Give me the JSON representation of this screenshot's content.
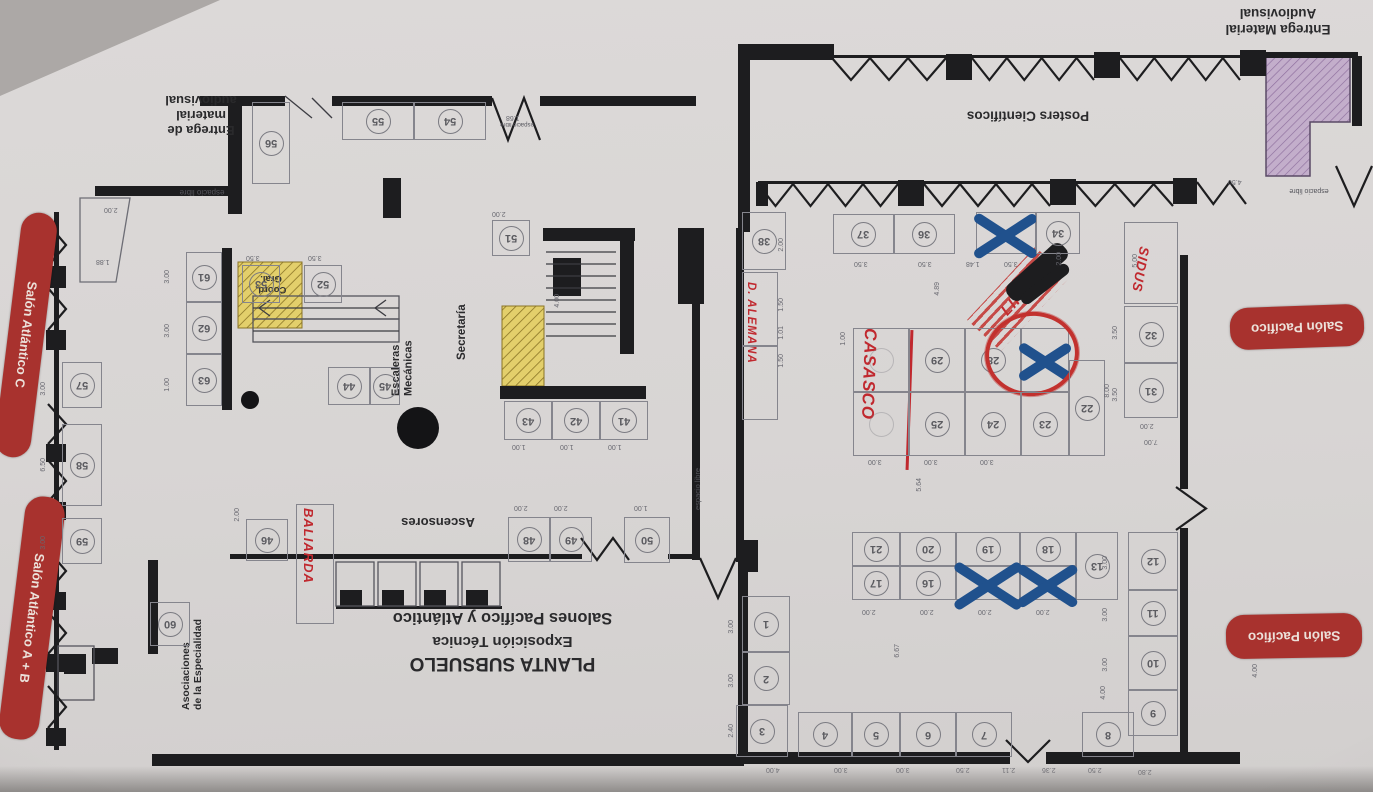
{
  "document": {
    "type": "floor-plan photo",
    "orientation": "rotated-180"
  },
  "title": {
    "l1": "PLANTA SUBSUELO",
    "l2": "Exposición Técnica",
    "l3": "Salones Pacífico y Atlántico"
  },
  "labels": {
    "entrega_material_l1": "Entrega Material",
    "entrega_material_l2": "Audiovisual",
    "entrega_de_l1": "Entrega de",
    "entrega_de_l2": "material",
    "entrega_de_l3": "audiovisual",
    "posters": "Posters Científicos",
    "salon_atlantico_c": "Salón Atlántico C",
    "salon_atlantico_ab": "Salón Atlántico A + B",
    "salon_pacifico": "Salón Pacífico",
    "secretaria": "Secretaría",
    "escaleras_l1": "Escaleras",
    "escaleras_l2": "Mecánicas",
    "ascensores": "Ascensores",
    "asociaciones_l1": "Asociaciones",
    "asociaciones_l2": "de la Especialidad",
    "coord_l1": "Coord.",
    "coord_l2": "Gral.",
    "espacio_libre": "espacio libre"
  },
  "annotations": {
    "casasco": "CASASCO",
    "baliarda": "BALIARDA",
    "sidus": "SIDUS",
    "alemana": "D. ALEMANA",
    "crossed_out": "LIF"
  },
  "colors": {
    "paper": "#d9d6d5",
    "wall": "#1d1d1d",
    "pill_red": "#a8322e",
    "handwriting_red": "#c0282e",
    "marker_blue": "#20518d",
    "highlight_yellow": "#e3cf6b",
    "highlight_purple": "#c3aecb"
  },
  "booths": [
    {
      "n": "38",
      "x": 742,
      "y": 212,
      "w": 44,
      "h": 58
    },
    {
      "n": "37",
      "x": 833,
      "y": 214,
      "w": 61,
      "h": 40
    },
    {
      "n": "36",
      "x": 894,
      "y": 214,
      "w": 61,
      "h": 40
    },
    {
      "n": "35",
      "x": 976,
      "y": 212,
      "w": 60,
      "h": 42,
      "mark": "x"
    },
    {
      "n": "34",
      "x": 1036,
      "y": 212,
      "w": 44,
      "h": 42
    },
    {
      "n": "39",
      "x": 742,
      "y": 272,
      "w": 36,
      "h": 74,
      "mark": "hide"
    },
    {
      "n": "40",
      "x": 742,
      "y": 346,
      "w": 36,
      "h": 74,
      "mark": "hide"
    },
    {
      "n": "33",
      "x": 1124,
      "y": 222,
      "w": 54,
      "h": 82,
      "mark": "hide"
    },
    {
      "n": "32",
      "x": 1124,
      "y": 306,
      "w": 54,
      "h": 57
    },
    {
      "n": "31",
      "x": 1124,
      "y": 363,
      "w": 54,
      "h": 55
    },
    {
      "n": "30",
      "x": 853,
      "y": 328,
      "w": 56,
      "h": 64,
      "mark": "faint"
    },
    {
      "n": "29",
      "x": 909,
      "y": 328,
      "w": 56,
      "h": 64
    },
    {
      "n": "28",
      "x": 965,
      "y": 328,
      "w": 56,
      "h": 64
    },
    {
      "n": "27",
      "x": 1021,
      "y": 328,
      "w": 48,
      "h": 64,
      "mark": "xr"
    },
    {
      "n": "26",
      "x": 853,
      "y": 392,
      "w": 56,
      "h": 64,
      "mark": "faint"
    },
    {
      "n": "25",
      "x": 909,
      "y": 392,
      "w": 56,
      "h": 64
    },
    {
      "n": "24",
      "x": 965,
      "y": 392,
      "w": 56,
      "h": 64
    },
    {
      "n": "23",
      "x": 1021,
      "y": 392,
      "w": 48,
      "h": 64
    },
    {
      "n": "22",
      "x": 1069,
      "y": 360,
      "w": 36,
      "h": 96
    },
    {
      "n": "21",
      "x": 852,
      "y": 532,
      "w": 48,
      "h": 34
    },
    {
      "n": "20",
      "x": 900,
      "y": 532,
      "w": 56,
      "h": 34
    },
    {
      "n": "19",
      "x": 956,
      "y": 532,
      "w": 64,
      "h": 34
    },
    {
      "n": "18",
      "x": 1020,
      "y": 532,
      "w": 56,
      "h": 34
    },
    {
      "n": "13",
      "x": 1076,
      "y": 532,
      "w": 42,
      "h": 68
    },
    {
      "n": "17",
      "x": 852,
      "y": 566,
      "w": 48,
      "h": 34
    },
    {
      "n": "16",
      "x": 900,
      "y": 566,
      "w": 56,
      "h": 34
    },
    {
      "n": "14",
      "x": 956,
      "y": 566,
      "w": 64,
      "h": 34,
      "mark": "x"
    },
    {
      "n": "15",
      "x": 1020,
      "y": 566,
      "w": 56,
      "h": 34,
      "mark": "x"
    },
    {
      "n": "12",
      "x": 1128,
      "y": 532,
      "w": 50,
      "h": 58
    },
    {
      "n": "11",
      "x": 1128,
      "y": 590,
      "w": 50,
      "h": 46
    },
    {
      "n": "10",
      "x": 1128,
      "y": 636,
      "w": 50,
      "h": 54
    },
    {
      "n": "9",
      "x": 1128,
      "y": 690,
      "w": 50,
      "h": 46
    },
    {
      "n": "8",
      "x": 1082,
      "y": 712,
      "w": 52,
      "h": 45
    },
    {
      "n": "7",
      "x": 956,
      "y": 712,
      "w": 56,
      "h": 45
    },
    {
      "n": "6",
      "x": 900,
      "y": 712,
      "w": 56,
      "h": 45
    },
    {
      "n": "5",
      "x": 852,
      "y": 712,
      "w": 48,
      "h": 45
    },
    {
      "n": "4",
      "x": 798,
      "y": 712,
      "w": 54,
      "h": 45
    },
    {
      "n": "3",
      "x": 736,
      "y": 705,
      "w": 52,
      "h": 52
    },
    {
      "n": "2",
      "x": 742,
      "y": 652,
      "w": 48,
      "h": 53
    },
    {
      "n": "1",
      "x": 742,
      "y": 596,
      "w": 48,
      "h": 56
    },
    {
      "n": "56",
      "x": 252,
      "y": 102,
      "w": 38,
      "h": 82
    },
    {
      "n": "55",
      "x": 342,
      "y": 102,
      "w": 72,
      "h": 38
    },
    {
      "n": "54",
      "x": 414,
      "y": 102,
      "w": 72,
      "h": 38
    },
    {
      "n": "61",
      "x": 186,
      "y": 252,
      "w": 36,
      "h": 50
    },
    {
      "n": "62",
      "x": 186,
      "y": 302,
      "w": 36,
      "h": 52
    },
    {
      "n": "63",
      "x": 186,
      "y": 354,
      "w": 36,
      "h": 52
    },
    {
      "n": "57",
      "x": 62,
      "y": 362,
      "w": 40,
      "h": 46
    },
    {
      "n": "58",
      "x": 62,
      "y": 424,
      "w": 40,
      "h": 82
    },
    {
      "n": "59",
      "x": 62,
      "y": 518,
      "w": 40,
      "h": 46
    },
    {
      "n": "60",
      "x": 150,
      "y": 602,
      "w": 40,
      "h": 44
    },
    {
      "n": "53",
      "x": 242,
      "y": 265,
      "w": 38,
      "h": 38
    },
    {
      "n": "52",
      "x": 304,
      "y": 265,
      "w": 38,
      "h": 38
    },
    {
      "n": "51",
      "x": 492,
      "y": 220,
      "w": 38,
      "h": 36
    },
    {
      "n": "44",
      "x": 328,
      "y": 367,
      "w": 42,
      "h": 38
    },
    {
      "n": "45",
      "x": 370,
      "y": 367,
      "w": 30,
      "h": 38
    },
    {
      "n": "43",
      "x": 504,
      "y": 401,
      "w": 48,
      "h": 39
    },
    {
      "n": "42",
      "x": 552,
      "y": 401,
      "w": 48,
      "h": 39
    },
    {
      "n": "41",
      "x": 600,
      "y": 401,
      "w": 48,
      "h": 39
    },
    {
      "n": "46",
      "x": 246,
      "y": 519,
      "w": 42,
      "h": 42
    },
    {
      "n": "47",
      "x": 296,
      "y": 504,
      "w": 38,
      "h": 120,
      "mark": "hide"
    },
    {
      "n": "48",
      "x": 508,
      "y": 517,
      "w": 42,
      "h": 45
    },
    {
      "n": "49",
      "x": 550,
      "y": 517,
      "w": 42,
      "h": 45
    },
    {
      "n": "50",
      "x": 624,
      "y": 517,
      "w": 46,
      "h": 46
    }
  ],
  "dims": [
    [
      "2.00",
      104,
      206,
      0
    ],
    [
      "1.88",
      96,
      258,
      0
    ],
    [
      "3.00",
      40,
      382,
      1
    ],
    [
      "6.50",
      40,
      458,
      1
    ],
    [
      "3.00",
      40,
      536,
      1
    ],
    [
      "3.00",
      164,
      270,
      1
    ],
    [
      "3.00",
      164,
      324,
      1
    ],
    [
      "1.00",
      164,
      378,
      1
    ],
    [
      "3.50",
      246,
      254,
      0
    ],
    [
      "3.50",
      308,
      254,
      0
    ],
    [
      "2.00",
      492,
      210,
      0
    ],
    [
      "4.00",
      554,
      294,
      1
    ],
    [
      "1.00",
      512,
      443,
      0
    ],
    [
      "1.00",
      560,
      443,
      0
    ],
    [
      "1.00",
      608,
      443,
      0
    ],
    [
      "2.00",
      514,
      504,
      0
    ],
    [
      "2.00",
      554,
      504,
      0
    ],
    [
      "1.00",
      634,
      504,
      0
    ],
    [
      "2.00",
      234,
      508,
      1
    ],
    [
      "3.50",
      854,
      260,
      0
    ],
    [
      "3.50",
      918,
      260,
      0
    ],
    [
      "1.48",
      966,
      260,
      0
    ],
    [
      "3.50",
      1004,
      260,
      0
    ],
    [
      "2.00",
      1056,
      252,
      1
    ],
    [
      "5.00",
      1132,
      254,
      1
    ],
    [
      "3.50",
      1112,
      326,
      1
    ],
    [
      "3.50",
      1112,
      388,
      1
    ],
    [
      "2.00",
      1140,
      422,
      0
    ],
    [
      "8.00",
      1104,
      384,
      1
    ],
    [
      "4.89",
      934,
      282,
      1
    ],
    [
      "1.00",
      840,
      332,
      1
    ],
    [
      "3.00",
      868,
      458,
      0
    ],
    [
      "3.00",
      924,
      458,
      0
    ],
    [
      "3.00",
      980,
      458,
      0
    ],
    [
      "5.64",
      916,
      478,
      1
    ],
    [
      "2.00",
      862,
      608,
      0
    ],
    [
      "2.00",
      920,
      608,
      0
    ],
    [
      "2.00",
      978,
      608,
      0
    ],
    [
      "2.00",
      1036,
      608,
      0
    ],
    [
      "6.67",
      894,
      644,
      1
    ],
    [
      "3.00",
      728,
      620,
      1
    ],
    [
      "3.00",
      728,
      674,
      1
    ],
    [
      "2.40",
      728,
      724,
      1
    ],
    [
      "4.00",
      766,
      766,
      0
    ],
    [
      "3.00",
      834,
      766,
      0
    ],
    [
      "3.00",
      896,
      766,
      0
    ],
    [
      "2.50",
      956,
      766,
      0
    ],
    [
      "2.11",
      1002,
      766,
      0
    ],
    [
      "2.36",
      1042,
      766,
      0
    ],
    [
      "2.50",
      1088,
      766,
      0
    ],
    [
      "2.80",
      1138,
      768,
      0
    ],
    [
      "3.00",
      1102,
      556,
      1
    ],
    [
      "3.00",
      1102,
      608,
      1
    ],
    [
      "3.00",
      1102,
      658,
      1
    ],
    [
      "4.00",
      1252,
      664,
      1
    ],
    [
      "4.00",
      1100,
      686,
      1
    ],
    [
      "4.50",
      1228,
      178,
      0
    ],
    [
      "1.68",
      506,
      114,
      0
    ],
    [
      "1.50",
      778,
      298,
      1
    ],
    [
      "1.01",
      778,
      326,
      1
    ],
    [
      "1.50",
      778,
      354,
      1
    ],
    [
      "2.00",
      778,
      238,
      1
    ],
    [
      "7.00",
      1144,
      438,
      0
    ]
  ]
}
